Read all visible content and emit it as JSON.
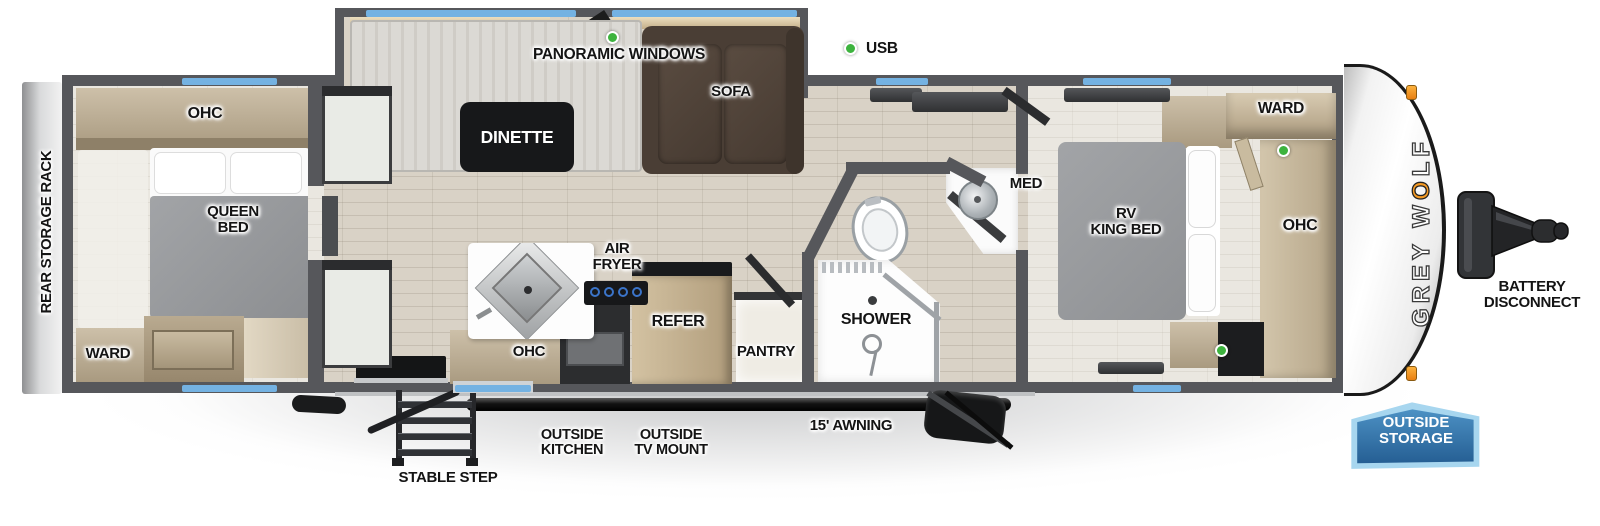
{
  "colors": {
    "wall": "#56575b",
    "floor_wood": "#d9d2c6",
    "floor_light": "#eae7e0",
    "window_blue": "#74b2e2",
    "usb_green": "#3db33e",
    "cabinet_tan": "#c3b49c",
    "counter_black": "#1d1e20",
    "sofa_brown": "#4a3e35",
    "mattress_gray": "#97999c",
    "refer_wood": "#c8b493",
    "logo_orange": "#f59a23",
    "flag_blue": "#2e6da4",
    "flag_border": "#a7d6ef"
  },
  "brand": {
    "name": "GREY WOLF",
    "pre": "GREY W",
    "paw_letter": "O",
    "post": "LF"
  },
  "exterior": {
    "rear_storage_rack": "REAR STORAGE RACK",
    "stable_step": "STABLE STEP",
    "outside_kitchen_1": "OUTSIDE",
    "outside_kitchen_2": "KITCHEN",
    "outside_tv_mount_1": "OUTSIDE",
    "outside_tv_mount_2": "TV MOUNT",
    "awning": "15' AWNING",
    "outside_storage_1": "OUTSIDE",
    "outside_storage_2": "STORAGE",
    "battery_1": "BATTERY",
    "battery_2": "DISCONNECT"
  },
  "interior": {
    "panoramic_windows": "PANORAMIC WINDOWS",
    "usb": "USB",
    "dinette": "DINETTE",
    "sofa": "SOFA",
    "ohc_rear": "OHC",
    "queen_bed_1": "QUEEN",
    "queen_bed_2": "BED",
    "ward_rear": "WARD",
    "air_fryer_1": "AIR",
    "air_fryer_2": "FRYER",
    "ohc_kitchen": "OHC",
    "refer": "REFER",
    "pantry": "PANTRY",
    "shower": "SHOWER",
    "med": "MED",
    "rv_king_1": "RV",
    "rv_king_2": "KING BED",
    "ward_front": "WARD",
    "ohc_front": "OHC"
  }
}
